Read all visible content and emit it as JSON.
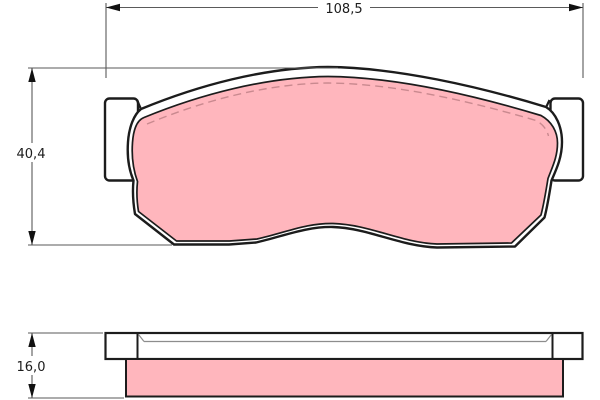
{
  "drawing": {
    "dimensions": {
      "overall_width": {
        "label": "108,5"
      },
      "overall_height": {
        "label": "40,4"
      },
      "thickness": {
        "label": "16,0"
      }
    },
    "colors": {
      "background": "#ffffff",
      "outline": "#1c1c1c",
      "backing_fill": "#ffffff",
      "friction_fill": "#ffb6bd",
      "chamfer_dash": "#c9898f",
      "dimension_line": "#5a5a5a",
      "arrowhead": "#111111",
      "label_text": "#1c1c1c"
    },
    "icons": {
      "arrowheads": [
        "dim-arrowhead-left",
        "dim-arrowhead-right",
        "dim-arrowhead-up",
        "dim-arrowhead-down"
      ]
    }
  }
}
